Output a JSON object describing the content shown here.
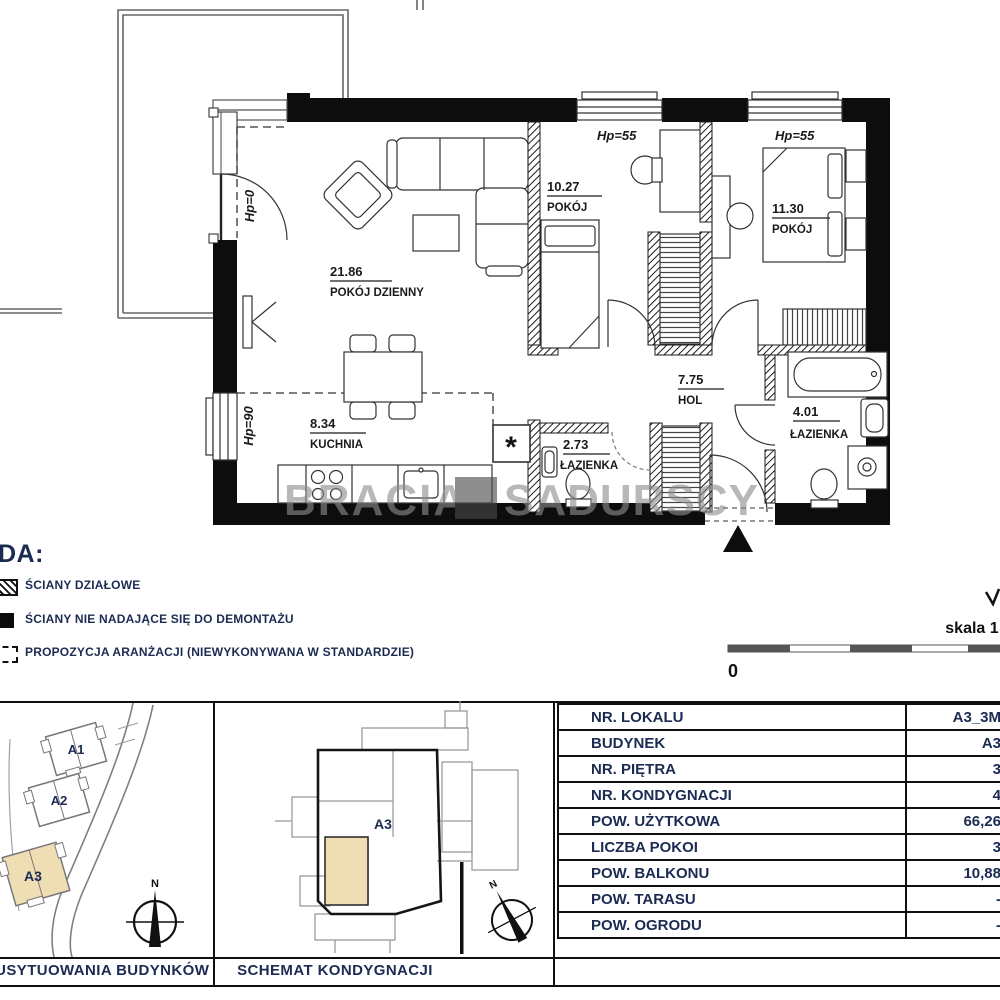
{
  "watermark": {
    "left": "BRACIA",
    "right": "SADURSCY"
  },
  "plan": {
    "rooms": [
      {
        "area": "21.86",
        "name": "POKÓJ DZIENNY"
      },
      {
        "area": "10.27",
        "name": "POKÓJ"
      },
      {
        "area": "11.30",
        "name": "POKÓJ"
      },
      {
        "area": "8.34",
        "name": "KUCHNIA"
      },
      {
        "area": "2.73",
        "name": "ŁAZIENKA"
      },
      {
        "area": "7.75",
        "name": "HOL"
      },
      {
        "area": "4.01",
        "name": "ŁAZIENKA"
      }
    ],
    "hp_labels": [
      {
        "text": "Hp=55"
      },
      {
        "text": "Hp=55"
      },
      {
        "text": "Hp=0"
      },
      {
        "text": "Hp=90"
      }
    ],
    "asterisk": "*"
  },
  "legend": {
    "title": "DA:",
    "items": [
      {
        "label": "ŚCIANY DZIAŁOWE",
        "icon": "hatched-wall"
      },
      {
        "label": "ŚCIANY NIE NADAJĄCE SIĘ DO DEMONTAŻU",
        "icon": "solid-wall"
      },
      {
        "label": "PROPOZYCJA ARANŻACJI (NIEWYKONYWANA W STANDARDZIE)",
        "icon": "dashed-outline"
      }
    ]
  },
  "scale": {
    "label": "skala 1:",
    "zero": "0"
  },
  "site_plan": {
    "buildings": [
      {
        "label": "A1",
        "highlighted": false
      },
      {
        "label": "A2",
        "highlighted": false
      },
      {
        "label": "A3",
        "highlighted": true
      }
    ],
    "compass": "N",
    "caption": "SCHEMAT USYTUOWANIA BUDYNKÓW"
  },
  "floor_schematic": {
    "unit_label": "A3",
    "compass": "N",
    "caption": "SCHEMAT KONDYGNACJI"
  },
  "table": {
    "rows": [
      {
        "label": "NR. LOKALU",
        "value": "A3_3M"
      },
      {
        "label": "BUDYNEK",
        "value": "A3"
      },
      {
        "label": "NR. PIĘTRA",
        "value": "3"
      },
      {
        "label": "NR. KONDYGNACJI",
        "value": "4"
      },
      {
        "label": "POW. UŻYTKOWA",
        "value": "66,26"
      },
      {
        "label": "LICZBA POKOI",
        "value": "3"
      },
      {
        "label": "POW. BALKONU",
        "value": "10,88"
      },
      {
        "label": "POW. TARASU",
        "value": "-"
      },
      {
        "label": "POW. OGRODU",
        "value": "-"
      }
    ]
  },
  "colors": {
    "navy": "#1c2b52",
    "beige": "#efddb4",
    "wall_black": "#0d0d0d",
    "gray": "#8a8a8a"
  }
}
